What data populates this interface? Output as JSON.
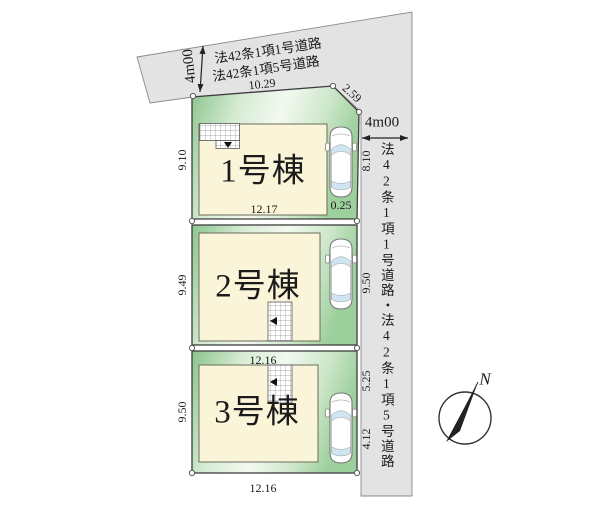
{
  "roads": {
    "top": {
      "width": "4m00",
      "line1": "法42条1項1号道路",
      "line2": "法42条1項5号道路",
      "frontage": "10.29",
      "corner": "2.59"
    },
    "right": {
      "width": "4m00",
      "name": "法42条1項1号道路・法42条1項5号道路"
    }
  },
  "lots": [
    {
      "label": "1号棟",
      "dim_left": "9.10",
      "dim_bottom": "12.17",
      "dim_right": "8.10",
      "dim_corner": "0.25"
    },
    {
      "label": "2号棟",
      "dim_left": "9.49",
      "dim_right": "9.50",
      "dim_bottom": "12.16"
    },
    {
      "label": "3号棟",
      "dim_left": "9.50",
      "dim_right_upper": "5.25",
      "dim_right_lower": "4.12",
      "dim_bottom": "12.16"
    }
  ],
  "compass": {
    "north": "N"
  },
  "colors": {
    "road_gray": "#e3e3e3",
    "road_edge": "#8a8a8a",
    "lot_green_edge": "#8cc48c",
    "lot_green_mid": "#d6ecd4",
    "lot_green_light": "#f3f9f1",
    "lot_green_mid2": "#cde7ca",
    "lot_green_edge2": "#9ed09d",
    "building_cream": "#faf5d8",
    "building_outline": "#6b6b5a",
    "lot_outline": "#3d3d3d",
    "window_blue": "#cfe6f2",
    "line_dark": "#222222"
  }
}
